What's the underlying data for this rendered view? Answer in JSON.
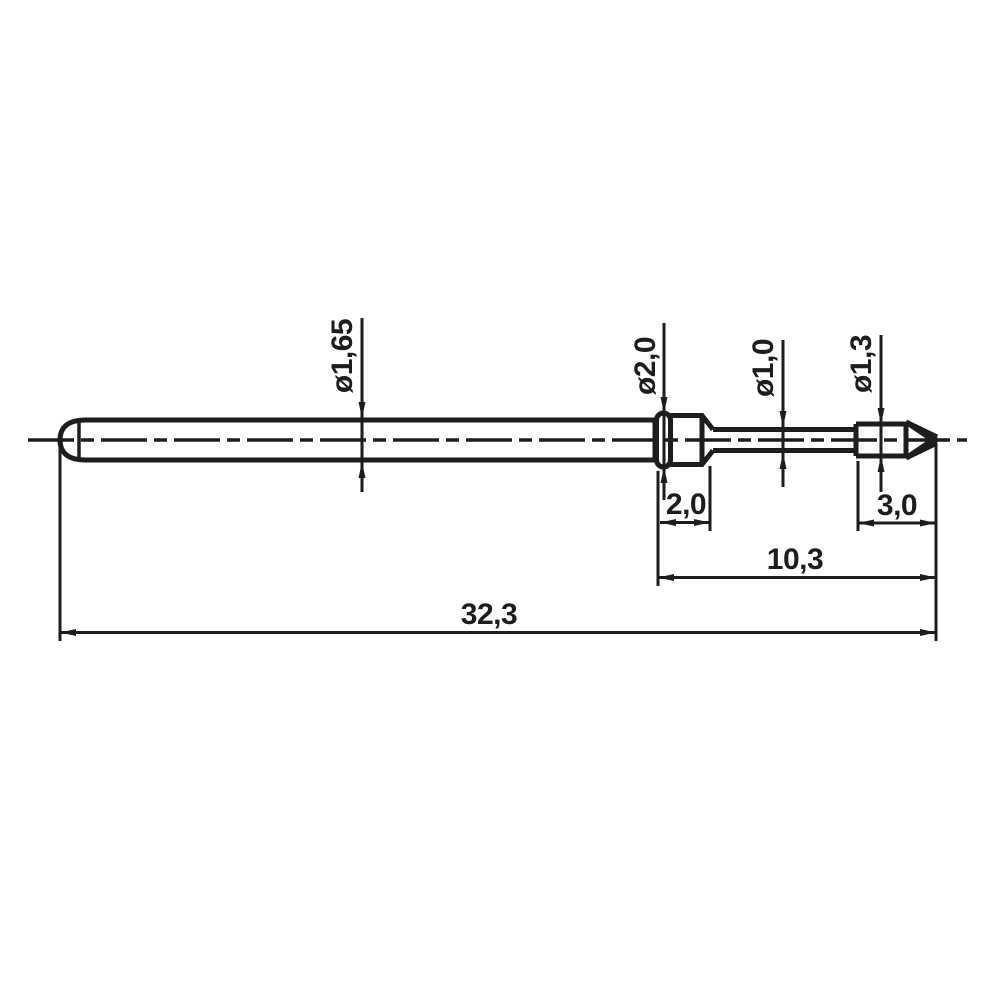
{
  "drawing": {
    "type": "technical-dimension-drawing",
    "subject": "spring-test-probe-side-view",
    "background_color": "#ffffff",
    "line_color": "#1d1d1b",
    "units_style": "comma-decimal",
    "labels": {
      "barrel_diameter": "ø1,65",
      "collar_diameter": "ø2,0",
      "plunger_diameter": "ø1,0",
      "tip_diameter": "ø1,3",
      "collar_length": "2,0",
      "tip_length": "3,0",
      "plunger_section_length": "10,3",
      "total_length": "32,3"
    }
  }
}
